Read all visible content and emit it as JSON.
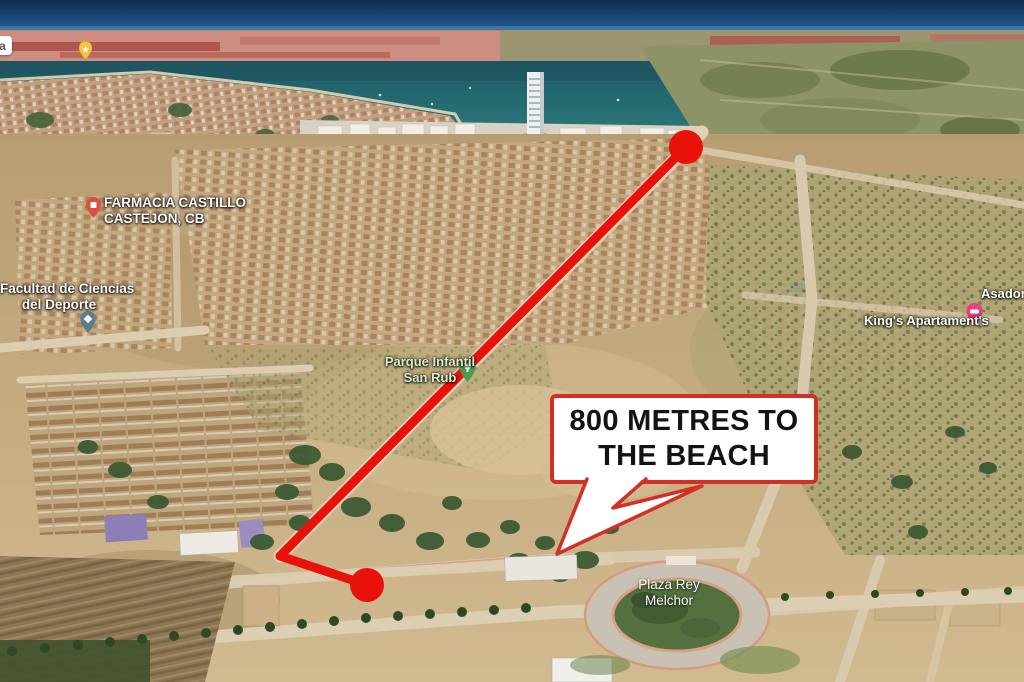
{
  "callout": {
    "line1": "800 METRES TO",
    "line2": "THE BEACH",
    "background": "#ffffff",
    "border_color": "#d22f27",
    "text_color": "#131313"
  },
  "route": {
    "color": "#e8120b",
    "dot_color": "#e8120b"
  },
  "labels": {
    "farmacia": {
      "line1": "FARMACIA CASTILLO",
      "line2": "CASTEJON, CB"
    },
    "facultad": {
      "line1": "Facultad de Ciencias",
      "line2": "del Deporte"
    },
    "parque": {
      "line1": "Parque Infantil",
      "line2": "San Rub"
    },
    "kings": {
      "text": "King's Apartament's"
    },
    "asador": {
      "text": "Asador"
    },
    "plaza": {
      "line1": "Plaza Rey",
      "line2": "Melchor"
    },
    "edge_partial": {
      "text": "a"
    }
  },
  "pins": {
    "star": {
      "color": "#f6c445"
    },
    "farmacia": {
      "color": "#dd4f43"
    },
    "facultad": {
      "color": "#5e7d8c"
    },
    "parque": {
      "color": "#4a9c4f"
    },
    "kings": {
      "color": "#e5427e"
    }
  }
}
